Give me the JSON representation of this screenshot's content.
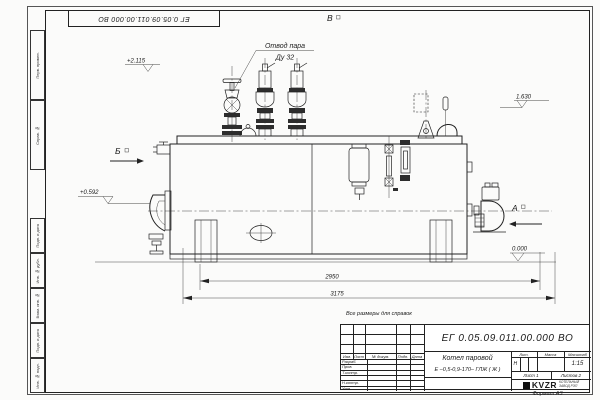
{
  "doc_number": "ЕГ 0.05.09.011.00.000  ВО",
  "sheet": {
    "reference_note": "Все размеры для справок",
    "format_note": "Формат А3"
  },
  "margin": {
    "top_cells": [
      "Перв. примен.",
      "Справ. №"
    ],
    "bottom_cells": [
      "Подп. и дата",
      "Инв. № дубл.",
      "Взам. инв. №",
      "Подп. и дата",
      "Инв. № подл."
    ]
  },
  "drawing": {
    "steam_outlet_label": "Отвод пара",
    "steam_outlet_dn": "Ду 32",
    "view_a": "А",
    "view_b": "Б",
    "view_v": "В",
    "elev_top": "+2.115",
    "elev_right": "1.630",
    "elev_left": "+0.592",
    "elev_zero": "0.000",
    "dim_inner": "2950",
    "dim_outer": "3175"
  },
  "title_block": {
    "product_name": "Котел паровой",
    "product_type": "Е –0,5-0,9-170– ГЛЖ ( Ж )",
    "header_cols": [
      "Изм.",
      "Лист",
      "№ докум.",
      "Подп.",
      "Дата"
    ],
    "rows": [
      "Разраб.",
      "Пров.",
      "Т.контр.",
      "",
      "Н.контр.",
      "Утв."
    ],
    "lit_label": "Лит.",
    "lit_value": "Н",
    "mass_label": "Масса",
    "scale_label": "Масштаб",
    "scale_value": "1:15",
    "sheet_cell": "Лист 1",
    "sheets_cell": "Листов 2",
    "logo_text": "KVZR",
    "company_line1": "КОТЕЛЬНЫЙ",
    "company_line2": "ЗАВОД РЭП"
  }
}
